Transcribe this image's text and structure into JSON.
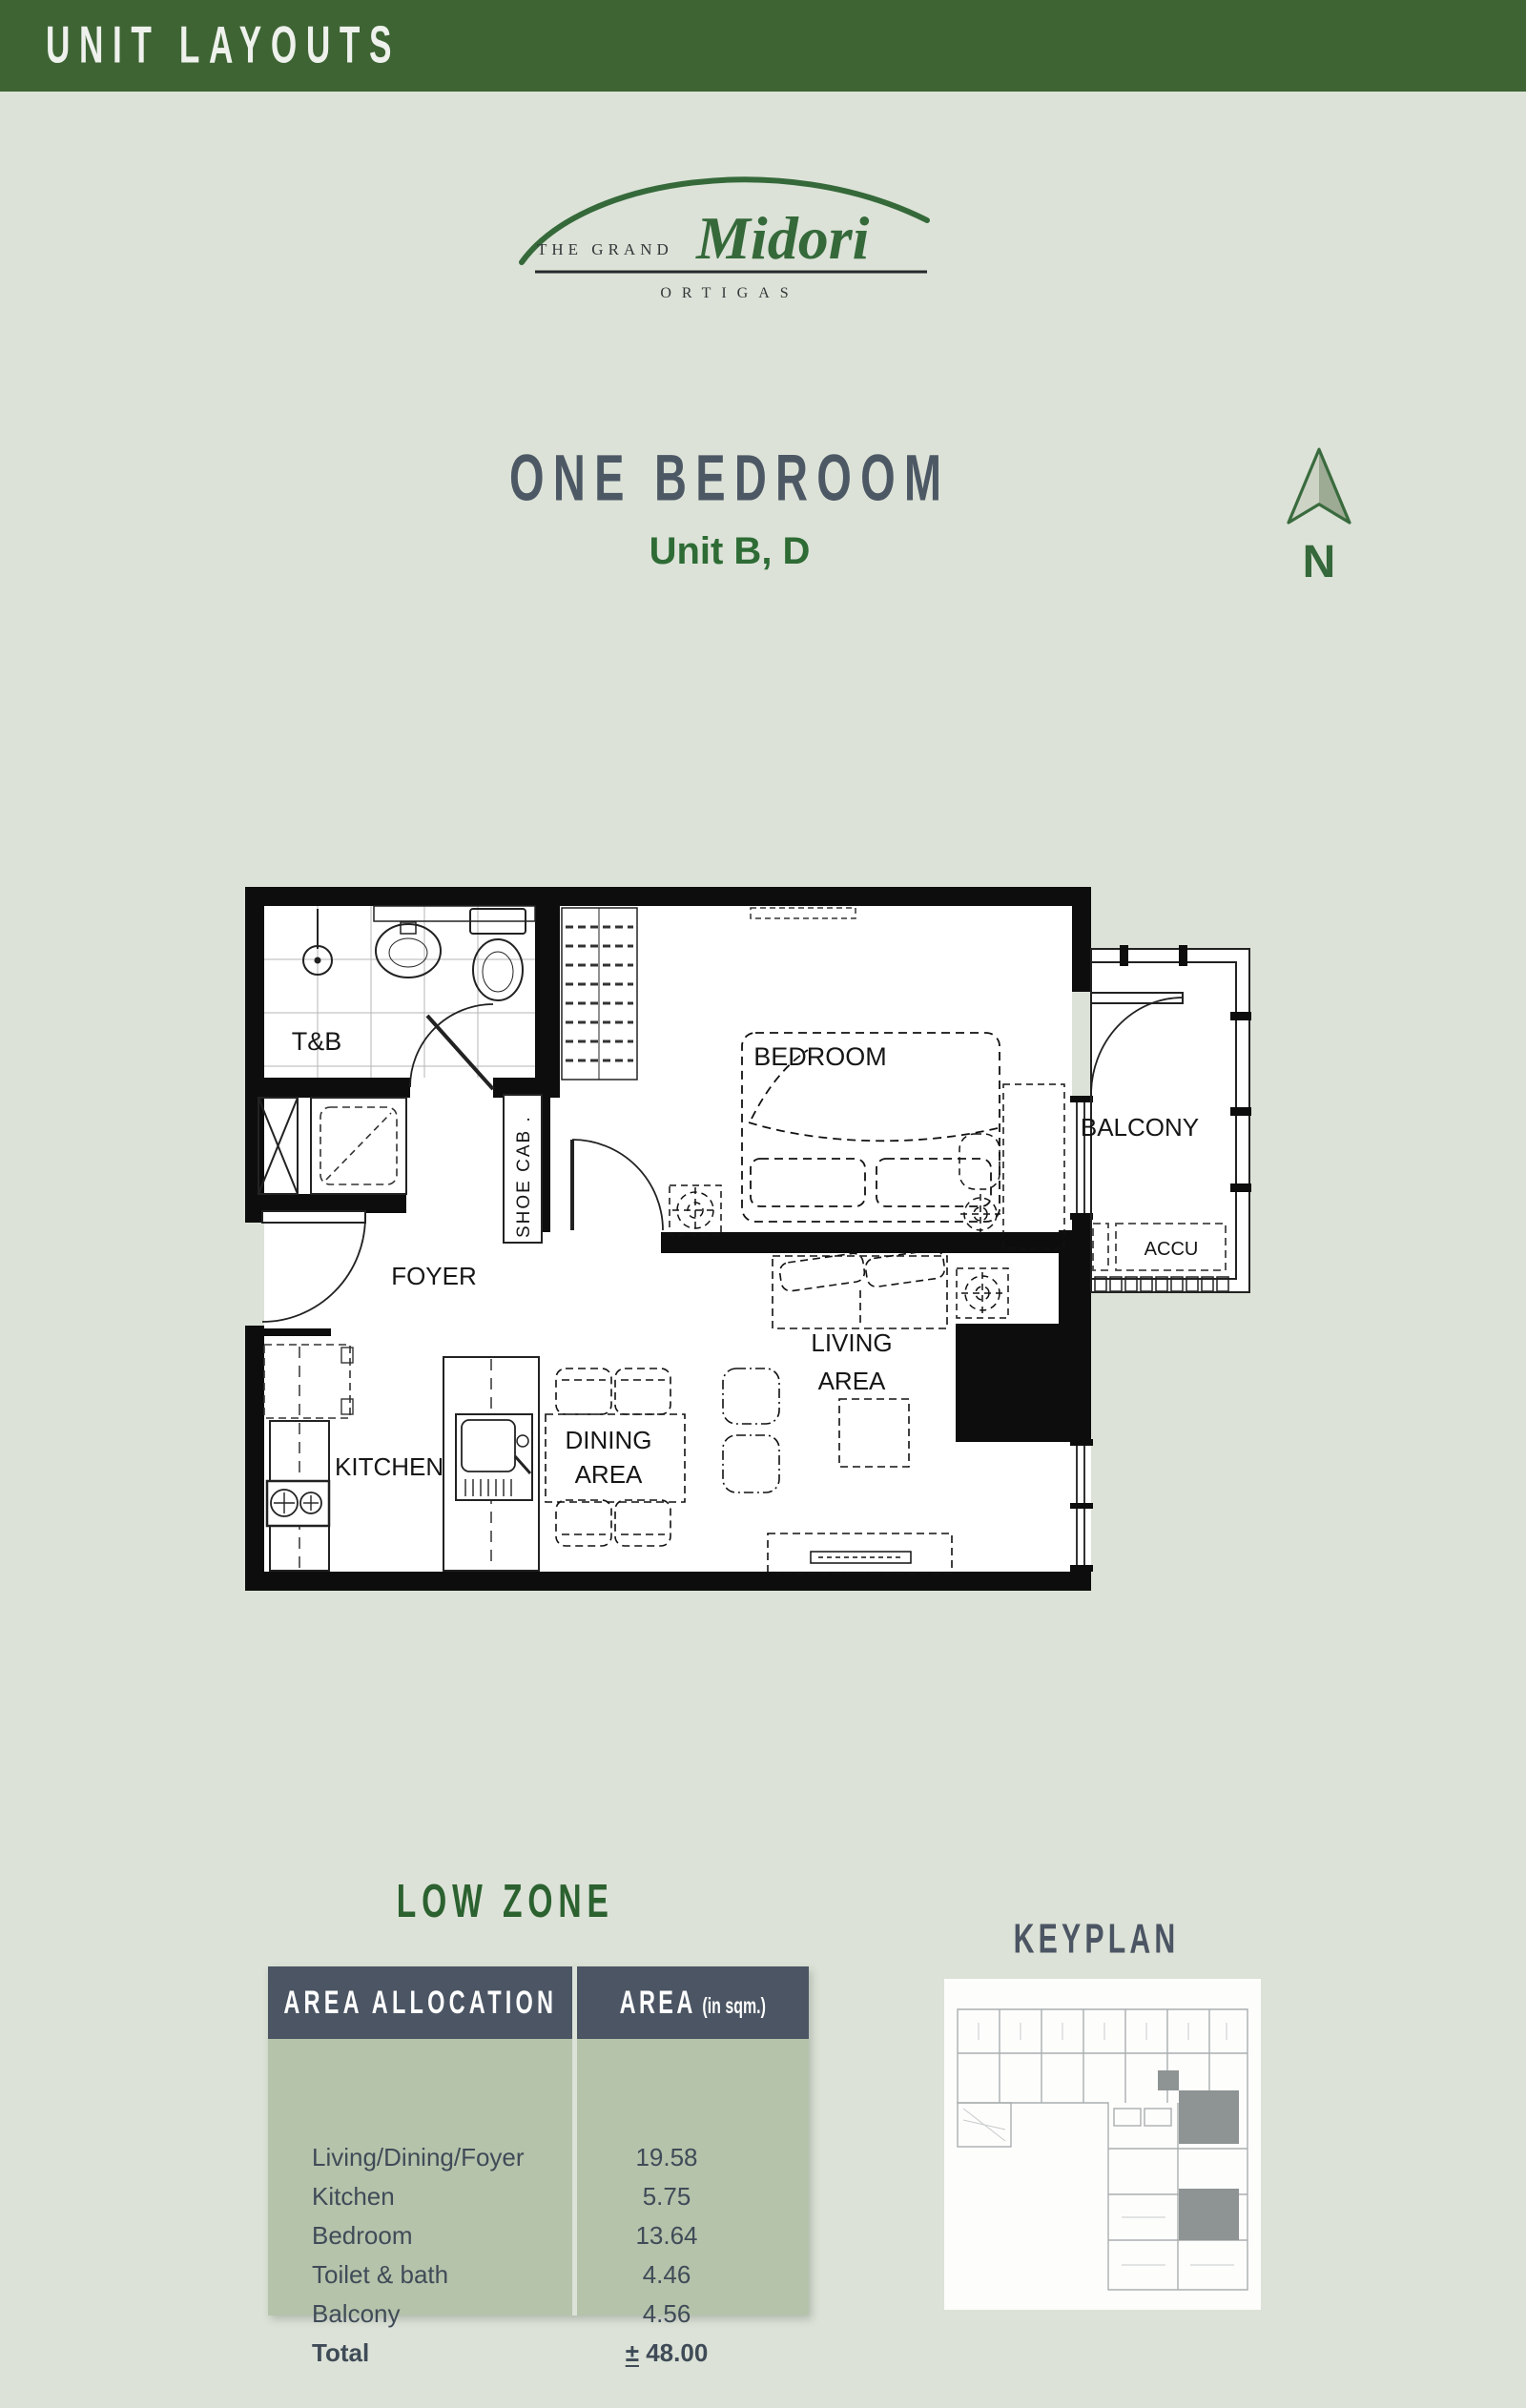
{
  "colors": {
    "page_bg": "#dce2d7",
    "header_green": "#3e6434",
    "accent_green": "#2e6b35",
    "logo_green": "#35693a",
    "slate": "#4b5563",
    "table_body_sage": "#b5c3ab",
    "plan_line": "#1a1a1a",
    "keyplan_highlight": "#8e9393"
  },
  "header": {
    "title": "UNIT LAYOUTS"
  },
  "logo": {
    "the_grand": "THE GRAND",
    "script": "Midori",
    "ortigas": "ORTIGAS"
  },
  "unit": {
    "title": "ONE BEDROOM",
    "subtitle": "Unit B, D"
  },
  "compass": {
    "label": "N"
  },
  "floor_plan": {
    "labels": {
      "tb": "T&B",
      "shoe_cab": "SHOE CAB .",
      "bedroom": "BEDROOM",
      "balcony": "BALCONY",
      "accu": "ACCU",
      "foyer": "FOYER",
      "kitchen": "KITCHEN",
      "dining_line1": "DINING",
      "dining_line2": "AREA",
      "living_line1": "LIVING",
      "living_line2": "AREA"
    }
  },
  "zone": {
    "title": "LOW ZONE"
  },
  "area_table": {
    "header": {
      "allocation": "AREA ALLOCATION",
      "area": "AREA",
      "area_unit": "(in sqm.)"
    },
    "rows": [
      {
        "label": "Living/Dining/Foyer",
        "value": "19.58"
      },
      {
        "label": "Kitchen",
        "value": "5.75"
      },
      {
        "label": "Bedroom",
        "value": "13.64"
      },
      {
        "label": "Toilet & bath",
        "value": "4.46"
      },
      {
        "label": "Balcony",
        "value": "4.56"
      }
    ],
    "total": {
      "label": "Total",
      "sign": "±",
      "value": "48.00"
    }
  },
  "keyplan": {
    "title": "KEYPLAN"
  }
}
